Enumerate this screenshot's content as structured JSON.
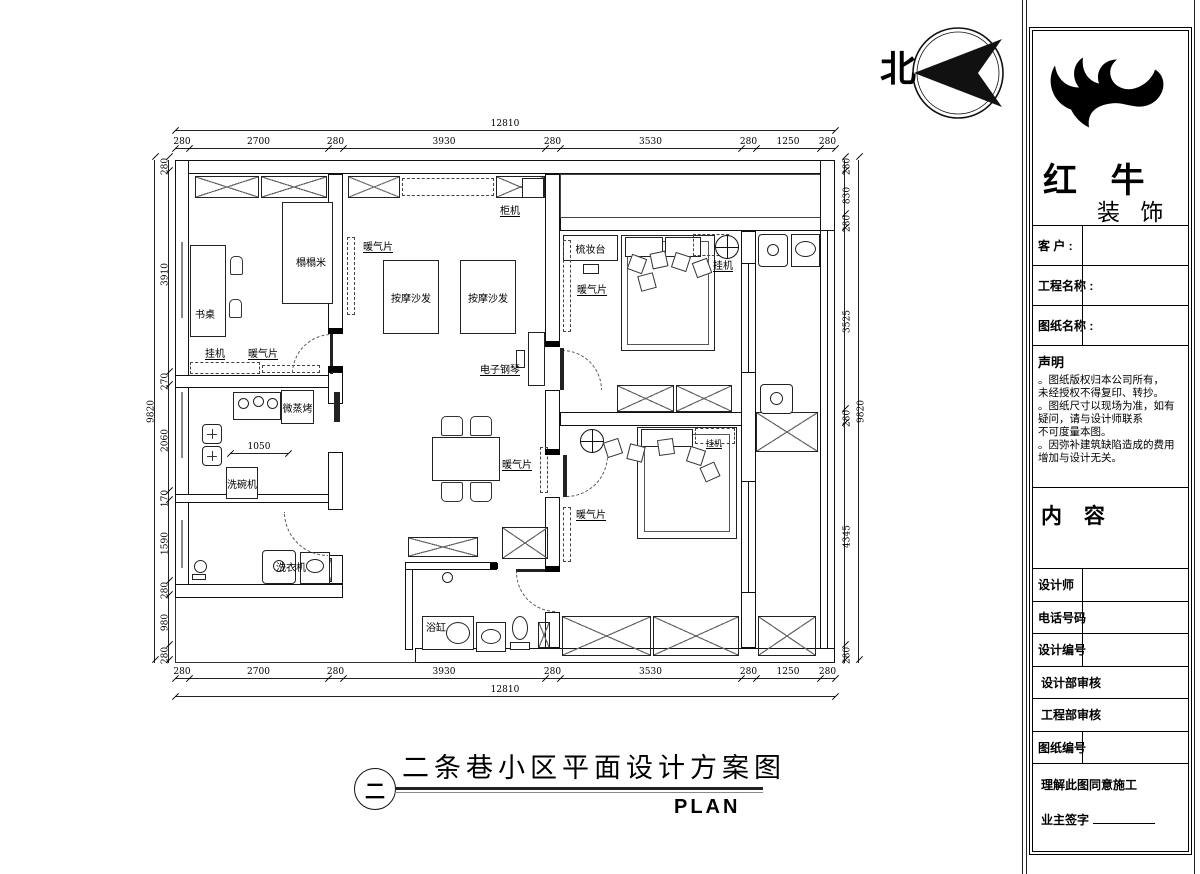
{
  "north": {
    "label": "北"
  },
  "footer_title": {
    "symbol": "二",
    "text": "二条巷小区平面设计方案图",
    "subtext": "PLAN"
  },
  "title_block": {
    "brand_line1": "红 牛",
    "brand_line2": "装 饰",
    "fields": [
      "客 户 :",
      "工程名称 :",
      "图纸名称 :"
    ],
    "statement_heading": "声明",
    "statement_items": [
      "。图纸版权归本公司所有，\n未经授权不得复印、转抄。",
      "。图纸尺寸以现场为准，如有\n疑问，请与设计师联系\n不可度量本图。",
      "。因弥补建筑缺陷造成的费用\n增加与设计无关。"
    ],
    "content_heading": "内 容",
    "rows": [
      "设计师",
      "电话号码",
      "设计编号",
      "设计部审核",
      "工程部审核",
      "图纸编号"
    ],
    "footer_line1": "理解此图同意施工",
    "footer_line2": "业主签字"
  },
  "dimensions": {
    "width_total": [
      "12810"
    ],
    "height_total": [
      "9820"
    ],
    "top_segments": [
      "280",
      "2700",
      "280",
      "3930",
      "280",
      "3530",
      "280",
      "1250",
      "280"
    ],
    "bottom_segments": [
      "280",
      "2700",
      "280",
      "3930",
      "280",
      "3530",
      "280",
      "1250",
      "280"
    ],
    "left_segments": [
      "280",
      "3910",
      "270",
      "2060",
      "170",
      "1590",
      "280",
      "980",
      "280"
    ],
    "right_segments": [
      "280",
      "830",
      "280",
      "3525",
      "280",
      "4345",
      "280"
    ],
    "kitchen_counter": [
      "1050"
    ]
  },
  "plan_labels": {
    "cabinet_ac": "柜机",
    "tatami": "榻榻米",
    "radiator": "暖气片",
    "desk": "书桌",
    "massage_sofa": "按摩沙发",
    "dresser": "梳妆台",
    "wall_ac": "挂机",
    "piano": "电子钢琴",
    "oven": "微蒸烤",
    "dishwasher": "洗碗机",
    "washing_machine": "洗衣机",
    "bathtub": "浴缸"
  }
}
